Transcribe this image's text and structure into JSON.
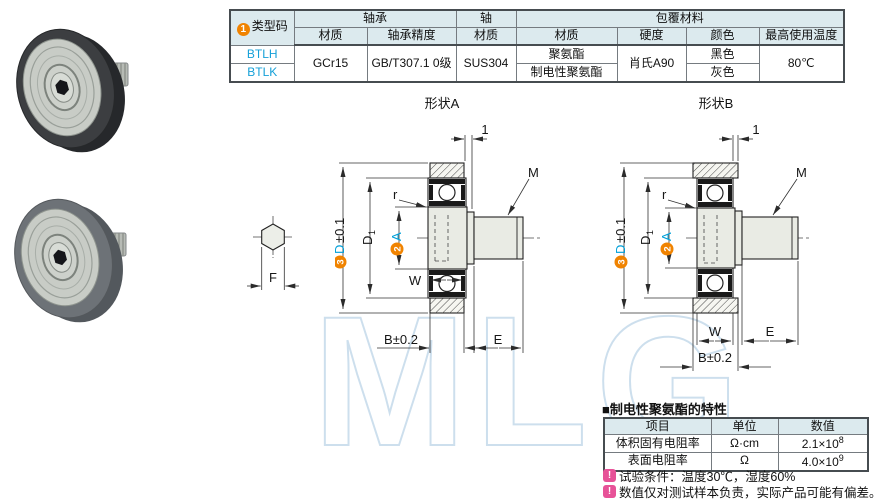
{
  "spec_table": {
    "badge": "1",
    "type_code_label": "类型码",
    "groups": {
      "bearing": "轴承",
      "shaft": "轴",
      "coating": "包覆材料"
    },
    "headers": {
      "bearing_material": "材质",
      "bearing_precision": "轴承精度",
      "shaft_material": "材质",
      "coating_material": "材质",
      "hardness": "硬度",
      "color": "颜色",
      "max_temp": "最高使用温度"
    },
    "rows": [
      {
        "code": "BTLH",
        "coating": "聚氨酯",
        "color": "黑色"
      },
      {
        "code": "BTLK",
        "coating": "制电性聚氨酯",
        "color": "灰色"
      }
    ],
    "values": {
      "bearing_material": "GCr15",
      "bearing_precision": "GB/T307.1 0级",
      "shaft_material": "SUS304",
      "hardness": "肖氏A90",
      "max_temp": "80℃"
    }
  },
  "drawings": {
    "shape_a_title": "形状A",
    "shape_b_title": "形状B",
    "labels": {
      "one": "1",
      "m": "M",
      "r": "r",
      "d_badge": "3",
      "d_letter": "D",
      "d_tol": "±0.1",
      "d1_letter": "D",
      "d1_sub": "1",
      "a_badge": "2",
      "a_letter": "A",
      "w": "W",
      "b_tol": "B±0.2",
      "e": "E",
      "f": "F"
    }
  },
  "properties": {
    "title": "■制电性聚氨酯的特性",
    "headers": [
      "项目",
      "单位",
      "数值"
    ],
    "rows": [
      {
        "item": "体积固有电阻率",
        "unit": "Ω·cm",
        "value_base": "2.1×10",
        "value_exp": "8"
      },
      {
        "item": "表面电阻率",
        "unit": "Ω",
        "value_base": "4.0×10",
        "value_exp": "9"
      }
    ]
  },
  "notes": [
    {
      "icon": "!",
      "text": "试验条件：温度30℃，湿度60%"
    },
    {
      "icon": "!",
      "text": "数值仅对测试样本负责，实际产品可能有偏差。"
    }
  ],
  "watermark": "MLG",
  "colors": {
    "accent_orange": "#f08300",
    "accent_blue": "#00a0d9",
    "note_pink": "#e75298",
    "header_bg": "#dceaee",
    "watermark_blue": "#c8dcec"
  }
}
